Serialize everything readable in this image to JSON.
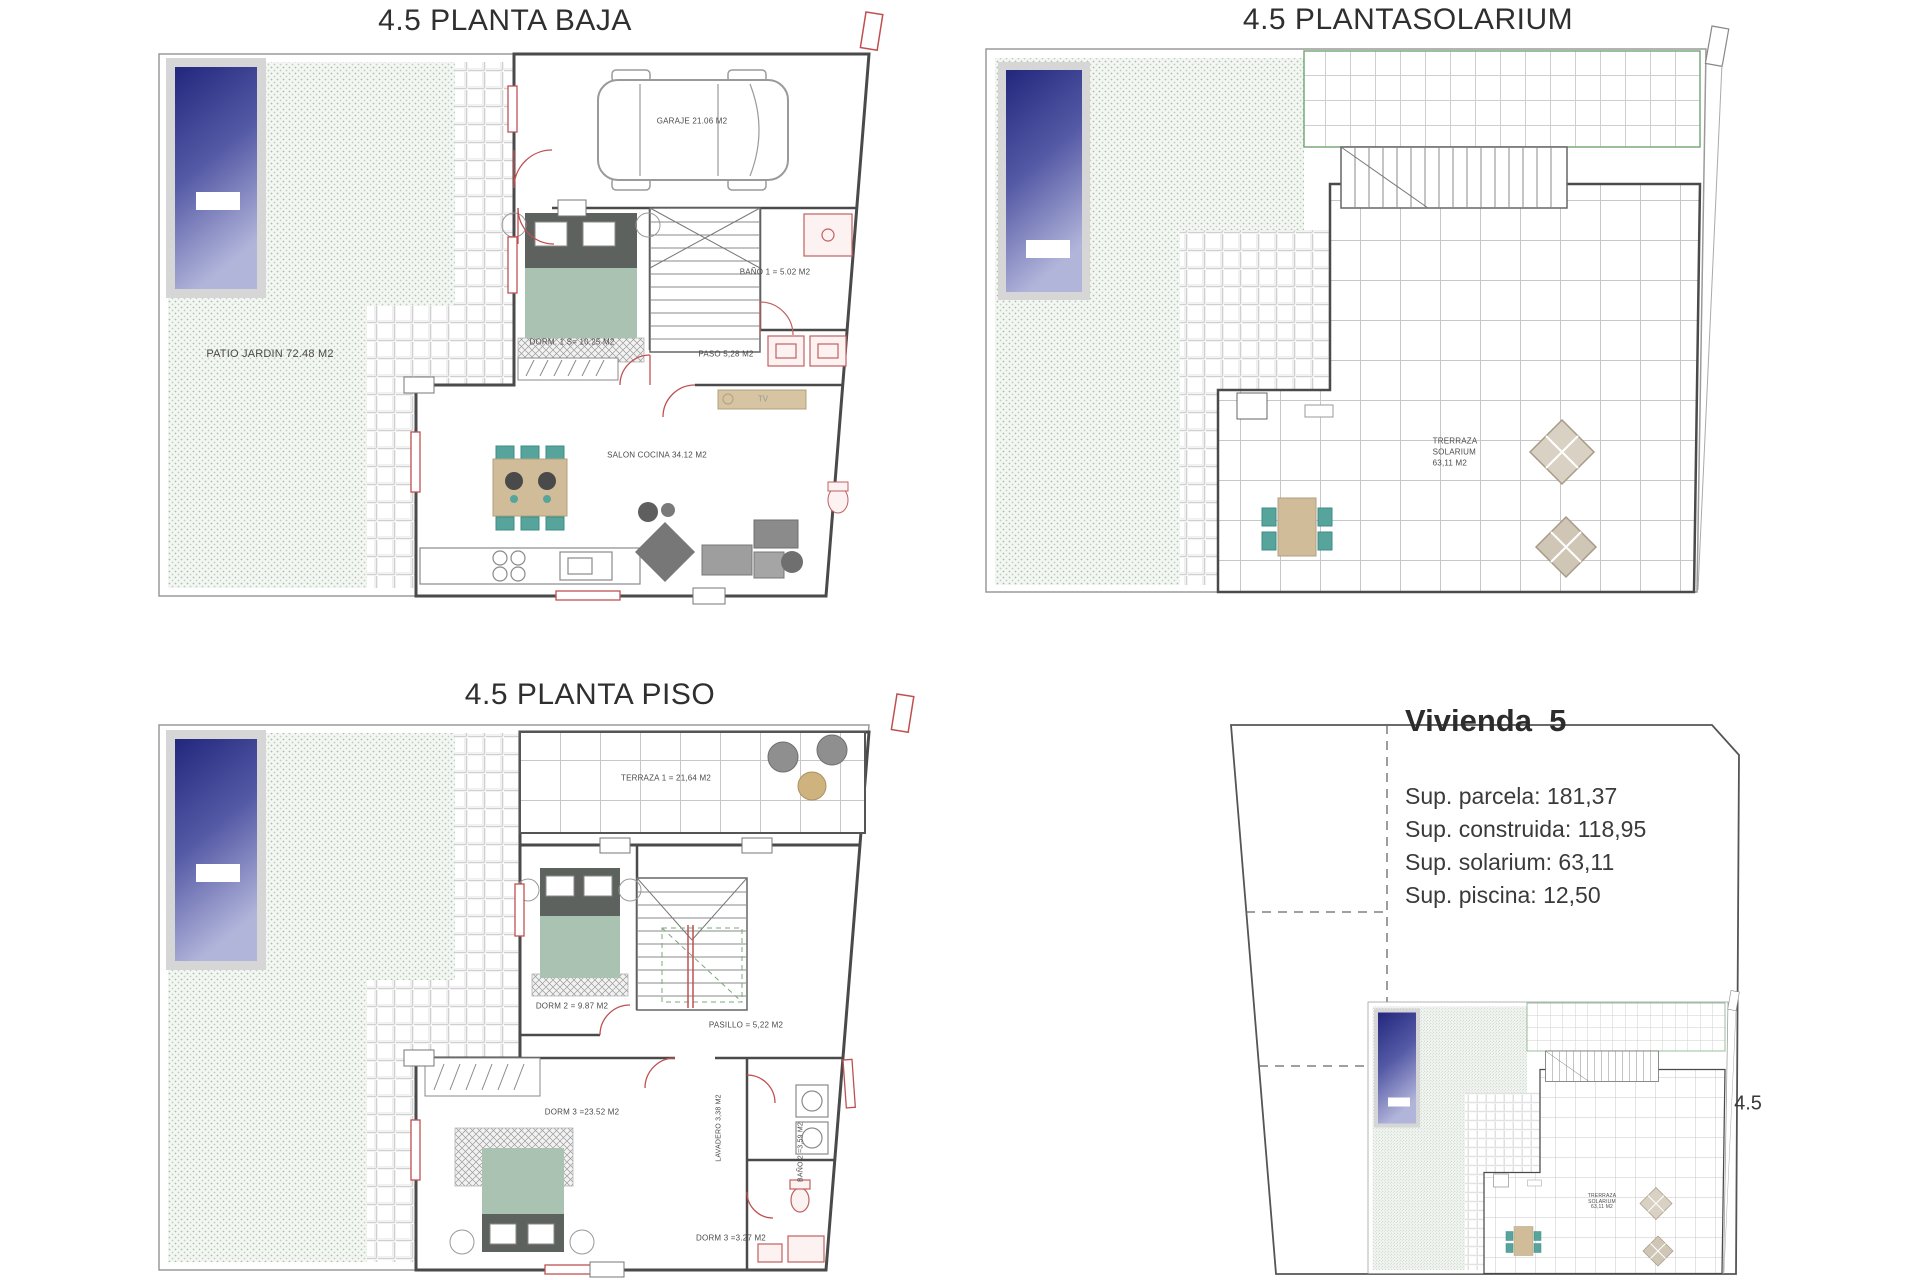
{
  "colors": {
    "wall": "#4a4a4a",
    "plot_border": "#9a9a9a",
    "red_accent": "#c05050",
    "garden_dot_green": "#a8c0a8",
    "pool_dark": "#23277d",
    "pool_light": "#b2b5da",
    "bed_green": "#a9c2b1",
    "furniture_tan": "#d0bc98",
    "chair_teal": "#57a49c",
    "strip_green": "#7aa87a"
  },
  "panels": {
    "baja": {
      "title": "4.5 PLANTA BAJA",
      "labels": {
        "patio": "PATIO JARDIN 72.48 M2",
        "garaje": "GARAJE 21.06 M2",
        "dorm1": "DORM. 1 S= 10.25 M2",
        "bano1": "BAÑO 1 =  5.02 M2",
        "paso": "PASO 5,28 M2",
        "salon": "SALON COCINA 34.12 M2",
        "tv": "TV"
      }
    },
    "solarium": {
      "title": "4.5 PLANTASOLARIUM",
      "labels": {
        "terraza_l1": "TRERRAZA",
        "terraza_l2": "SOLARIUM",
        "terraza_l3": "63,11 M2"
      }
    },
    "piso": {
      "title": "4.5 PLANTA PISO",
      "labels": {
        "terraza1": "TERRAZA 1 = 21,64 M2",
        "dorm2": "DORM 2 = 9.87 M2",
        "pasillo": "PASILLO = 5,22 M2",
        "dorm3": "DORM 3 =23.52 M2",
        "lavadero": "LAVADERO 3,38 M2",
        "bano2": "BAÑO 2 =3,59 M2",
        "dorm3b": "DORM 3 =3.27 M2"
      }
    },
    "vivienda": {
      "title": "Vivienda  5",
      "lines": [
        "Sup. parcela: 181,37",
        "Sup. construida: 118,95",
        "Sup. solarium: 63,11",
        "Sup. piscina: 12,50"
      ],
      "plot_ref": "4.5"
    }
  }
}
